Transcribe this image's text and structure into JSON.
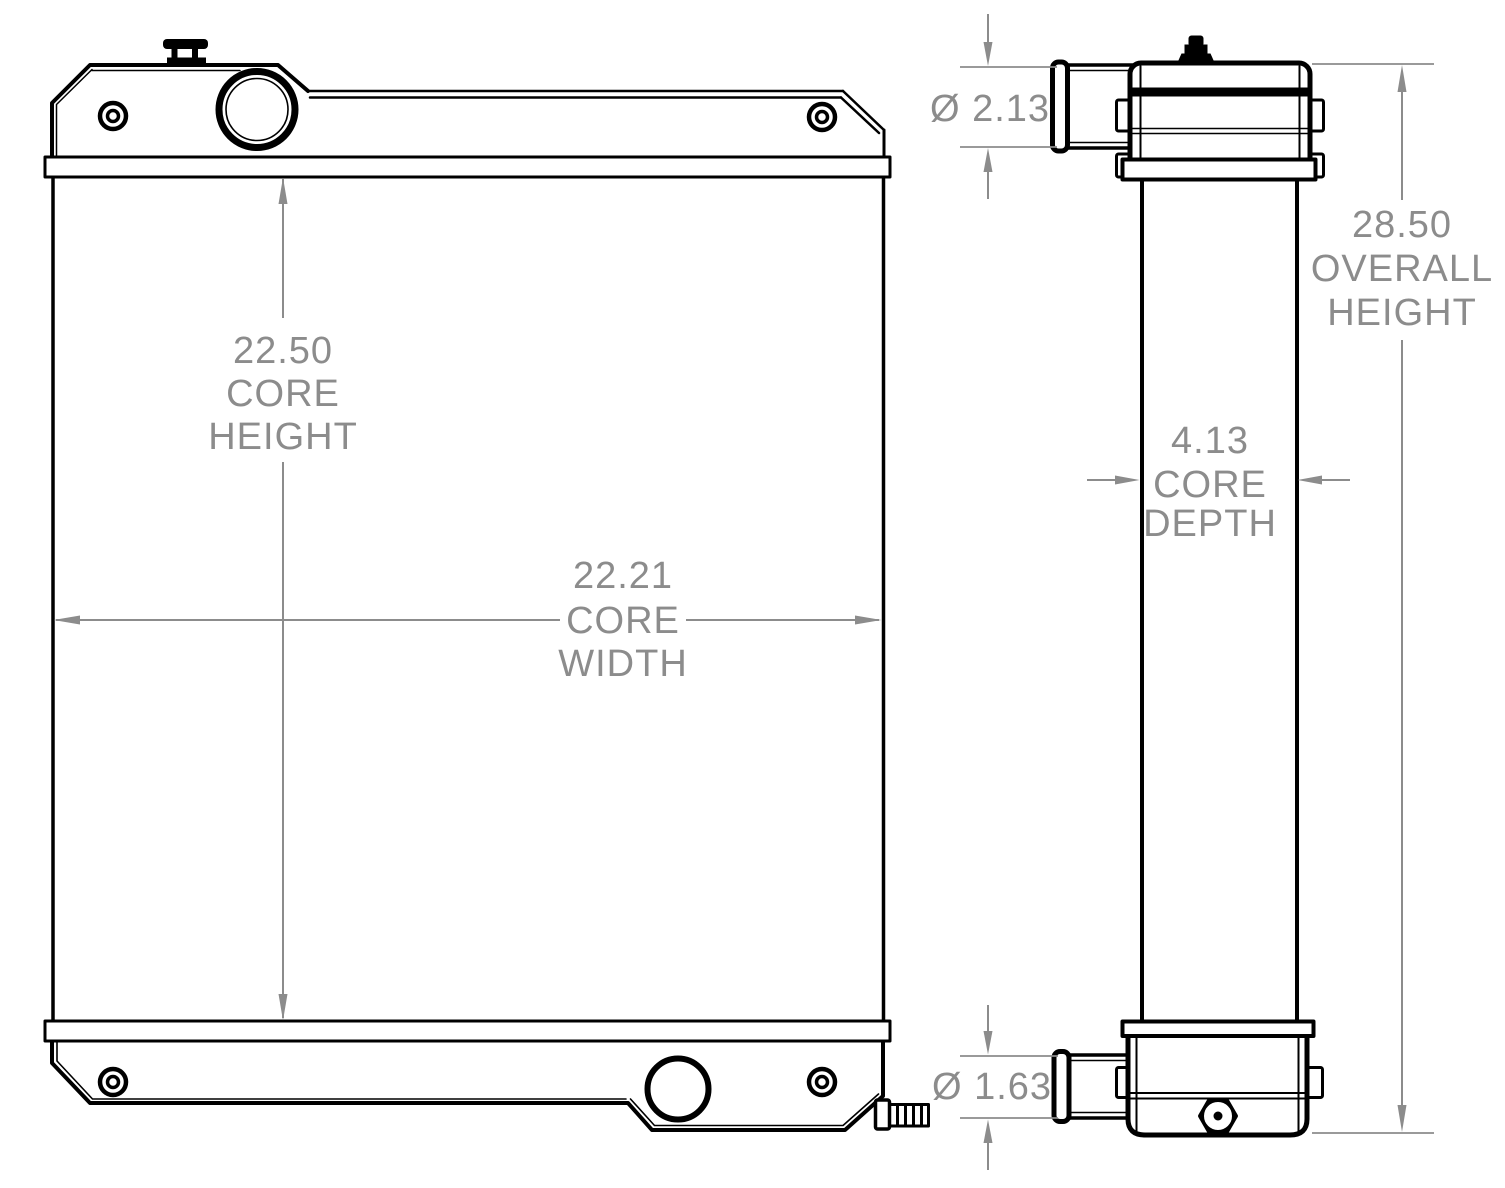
{
  "drawing": {
    "background_color": "#ffffff",
    "line_color": "#000000",
    "dimension_color": "#8c8c8c",
    "dimensions": {
      "core_height": {
        "value": "22.50",
        "label_line1": "CORE",
        "label_line2": "HEIGHT"
      },
      "core_width": {
        "value": "22.21",
        "label_line1": "CORE",
        "label_line2": "WIDTH"
      },
      "core_depth": {
        "value": "4.13",
        "label_line1": "CORE",
        "label_line2": "DEPTH"
      },
      "overall_height": {
        "value": "28.50",
        "label_line1": "OVERALL",
        "label_line2": "HEIGHT"
      },
      "top_inlet_diameter": {
        "value": "Ø 2.13"
      },
      "bottom_outlet_diameter": {
        "value": "Ø 1.63"
      }
    }
  }
}
